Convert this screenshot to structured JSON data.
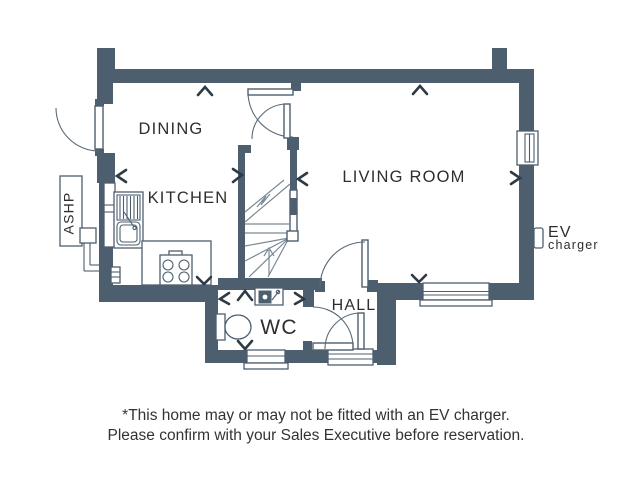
{
  "floorplan": {
    "rooms": {
      "dining": "DINING",
      "kitchen": "KITCHEN",
      "living_room": "LIVING ROOM",
      "hall": "HALL",
      "wc": "WC"
    },
    "equipment": {
      "ashp": "ASHP",
      "ev_line1": "EV",
      "ev_line2": "charger"
    },
    "colors": {
      "wall": "#4d5f6e",
      "stair_line": "#7b8995",
      "chevron": "#2e3a44",
      "text": "#2e2e2e"
    }
  },
  "caption": {
    "line1": "*This home may or may not be fitted with an EV charger.",
    "line2": "Please confirm with your Sales Executive before reservation."
  }
}
